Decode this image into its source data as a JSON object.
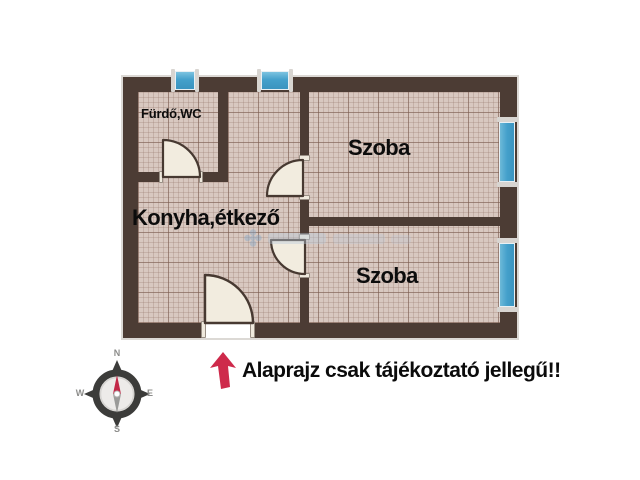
{
  "floorplan": {
    "labels": {
      "bathroom": "Fürdő,WC",
      "kitchen": "Konyha,étkező",
      "room_top": "Szoba",
      "room_bottom": "Szoba"
    },
    "symbols": {
      "windows": 4,
      "doors": 4
    },
    "colors": {
      "wall": "#4c3c34",
      "floor": "#d8c8c0",
      "window": "#44a0cb",
      "door": "#f2ecdf",
      "arrow": "#ce2a4b"
    }
  },
  "compass": {
    "north": "N",
    "east": "E",
    "south": "S",
    "west": "W"
  },
  "disclaimer": {
    "text": "Alaprajz csak tájékoztató jellegű!!"
  }
}
